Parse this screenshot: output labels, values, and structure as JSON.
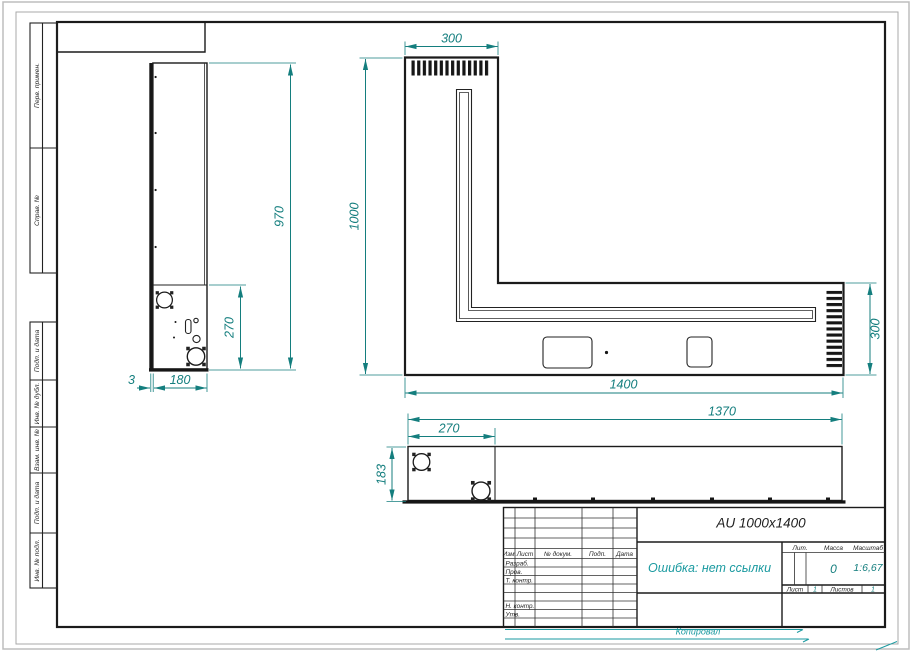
{
  "margin": {
    "labels": [
      "Перв. примен.",
      "Справ. №",
      "Подп. и дата",
      "Инв. № дубл.",
      "Взам. инв. №",
      "Подп. и дата",
      "Инв. № подл."
    ]
  },
  "views": {
    "side": {
      "dim_height": "970",
      "dim_box": "270",
      "dim_gap": "3",
      "dim_depth": "180"
    },
    "plan": {
      "dim_top_width": "300",
      "dim_height": "1000",
      "dim_length": "1400",
      "dim_right_width": "300"
    },
    "front": {
      "dim_length": "1370",
      "dim_left_section": "270",
      "dim_height": "183"
    }
  },
  "title_block": {
    "designation": "AU 1000x1400",
    "note": "Ошибка: нет ссылки",
    "columns": {
      "izm": "Изм.",
      "list": "Лист",
      "doc": "№ докум.",
      "podp": "Подп.",
      "data": "Дата"
    },
    "rows": {
      "razrab": "Разраб.",
      "prov": "Пров.",
      "tkontr": "Т. контр.",
      "nkontr": "Н. контр.",
      "utv": "Утв."
    },
    "lit_label": "Лит.",
    "massa_label": "Масса",
    "masshtab_label": "Масштаб",
    "massa_value": "0",
    "masshtab_value": "1:6,67",
    "list_label": "Лист",
    "list_value": "1",
    "listov_label": "Листов",
    "listov_value": "1",
    "footer": "Копировал"
  },
  "colors": {
    "line": "#1b1b1b",
    "dimension": "#147e7e",
    "accent": "#1a9aa0"
  }
}
